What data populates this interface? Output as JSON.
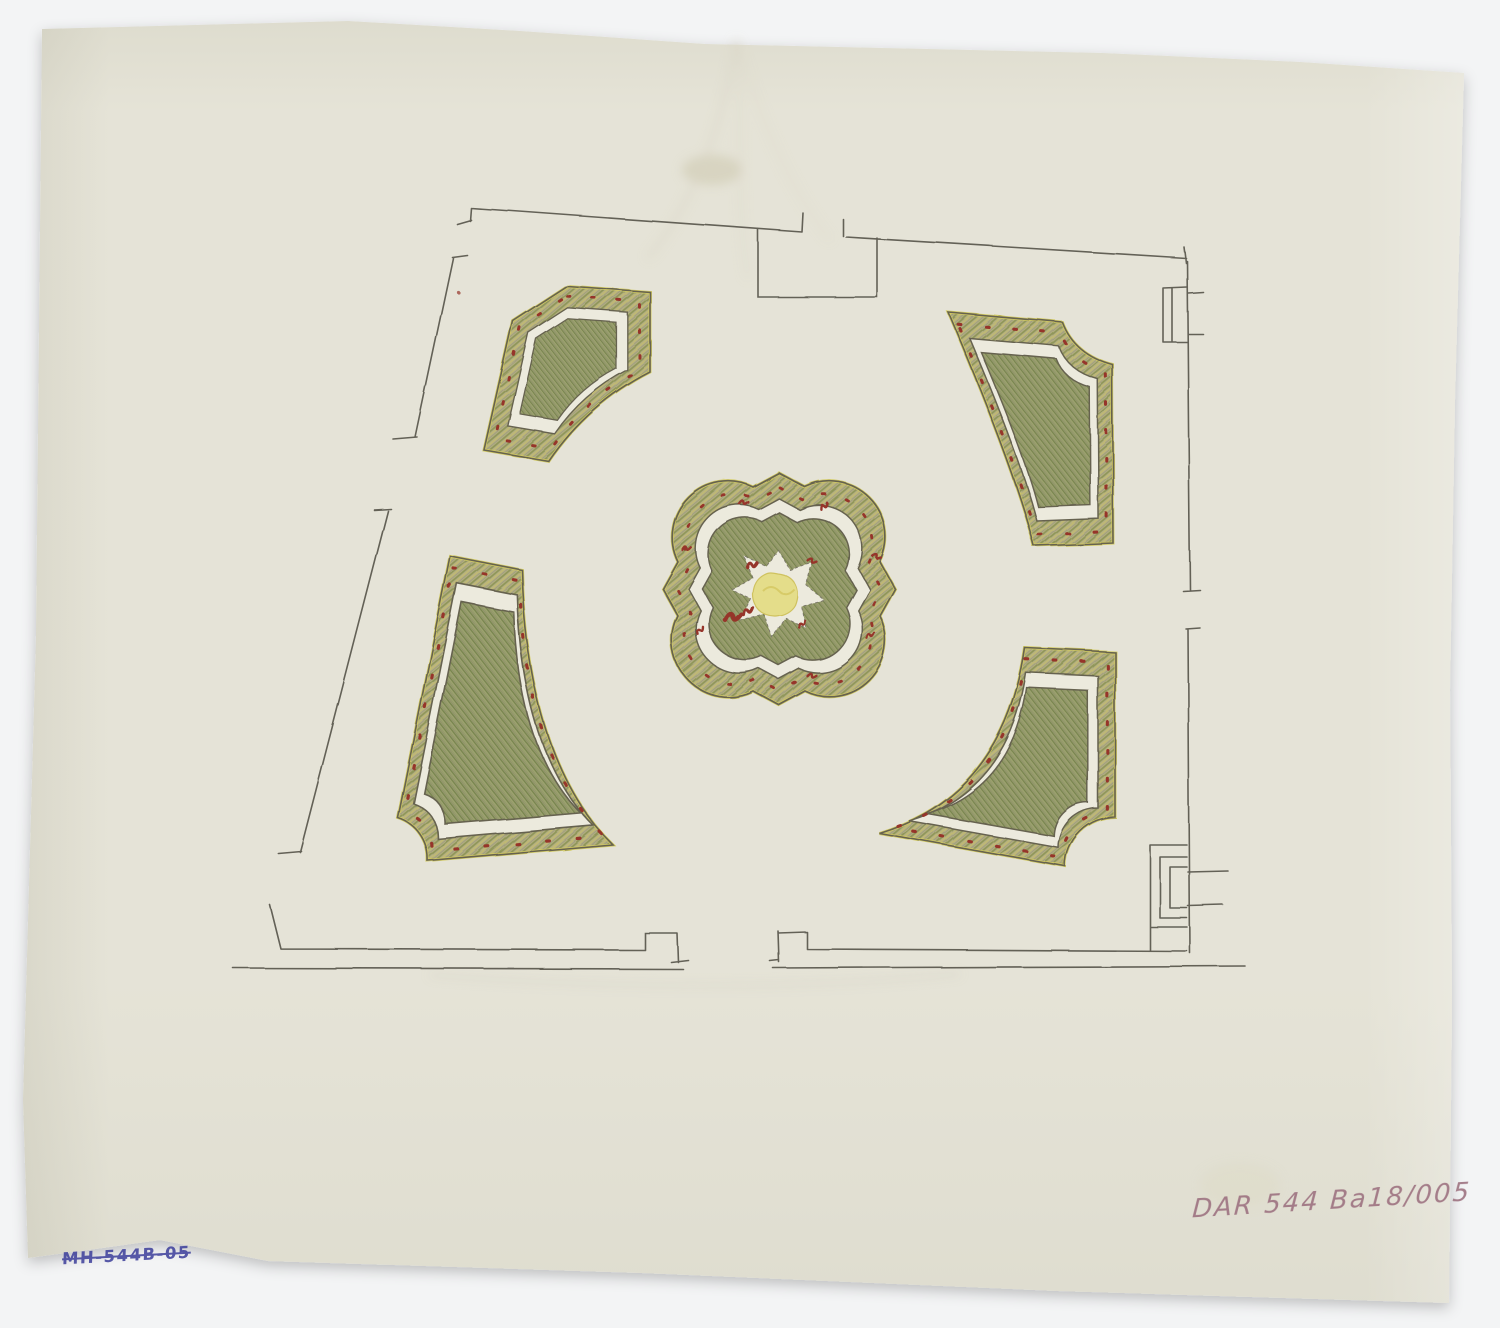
{
  "annotations": {
    "catalog_number_pink": "DAR 544 Ba18/005",
    "inventory_number_blue": "MH-544B-05"
  },
  "palette": {
    "background": "#f3f4f5",
    "paper": "#e7e5d9",
    "pencil_gray": "#55524a",
    "hedge_green_band": "#a9a673",
    "hedge_green_core": "#8f9765",
    "flower_red": "#96352b",
    "edging_yellow": "#d3cb62",
    "fountain_yellow": "#e4dd8a",
    "ink_blue": "#3c3e9b",
    "pencil_pink": "#9d7280"
  }
}
